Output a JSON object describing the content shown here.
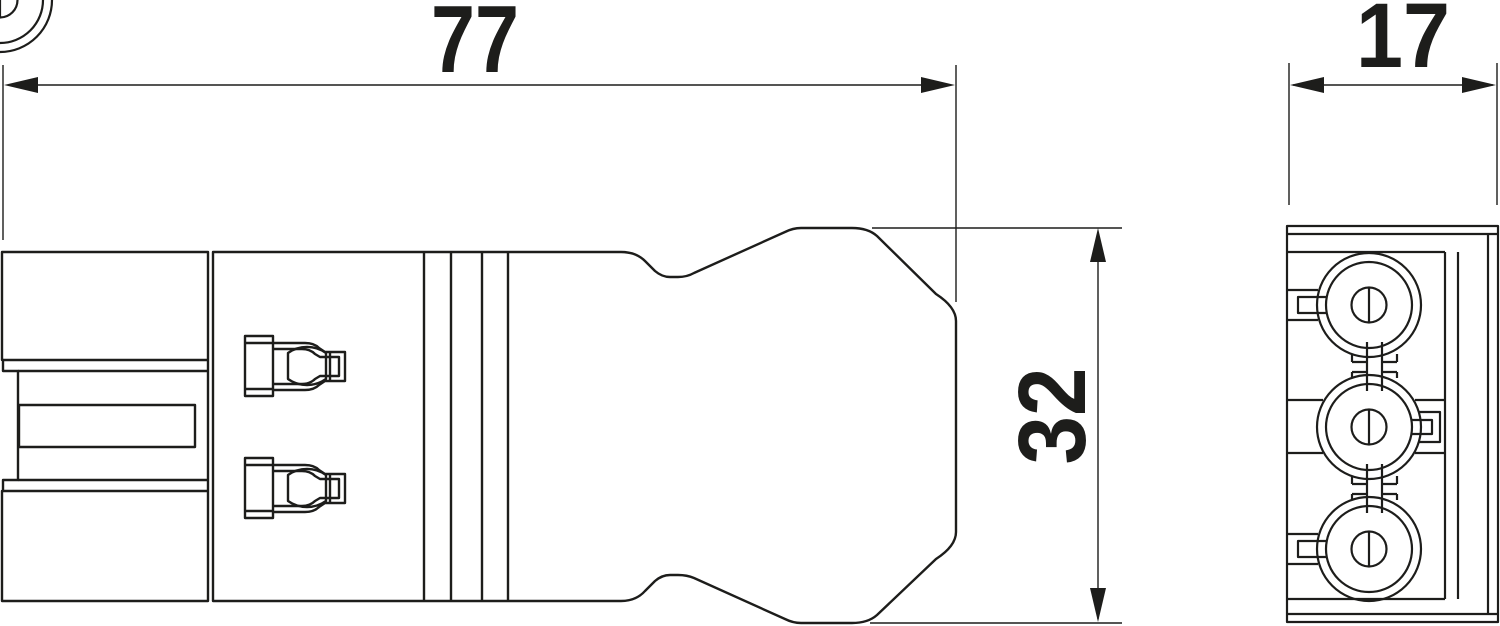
{
  "drawing": {
    "dimensions": {
      "overall_length_mm": "77",
      "overall_height_mm": "32",
      "overall_width_mm": "17"
    },
    "colors": {
      "line": "#1d1d1b",
      "background": "#ffffff"
    }
  }
}
